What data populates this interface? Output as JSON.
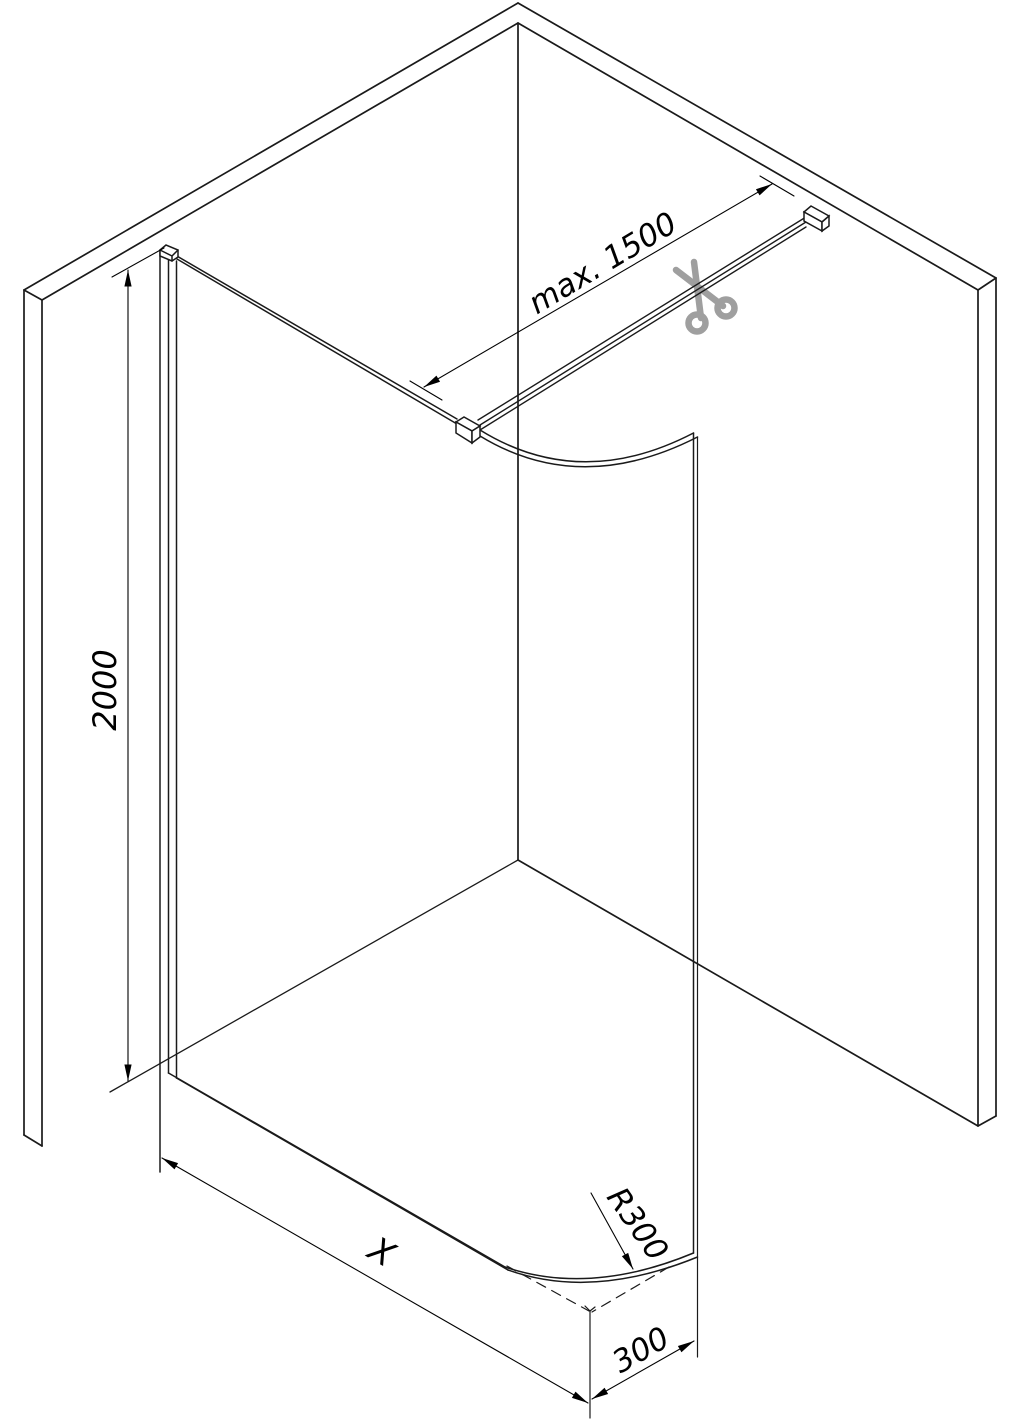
{
  "diagram": {
    "title": "Walk-in shower glass screen installation drawing",
    "type": "isometric technical diagram",
    "labels": {
      "bar_length": "max. 1500",
      "height": "2000",
      "width": "X",
      "corner_radius": "R300",
      "corner_offset": "300"
    },
    "icons": {
      "scissors": "cut-to-length-indicator"
    },
    "colors": {
      "line": "#1a1a1a",
      "dimension": "#000000",
      "scissors": "#8f8f8f",
      "background": "#ffffff"
    }
  }
}
